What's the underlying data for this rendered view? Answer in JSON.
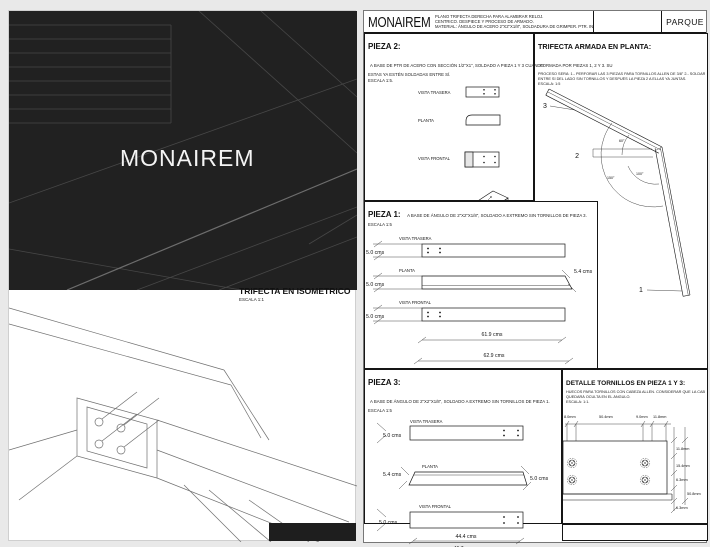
{
  "left_page": {
    "cover_title": "MONAIREM",
    "iso_title": "TRIFECTA EN ISOMETRICO",
    "iso_scale": "ESCALA 1:1"
  },
  "sheet": {
    "title_block": {
      "brand": "MONAIREM",
      "note_line1": "PLANO TRIFECTA DERECHA PARA ALAMBRAR RELOJ.",
      "note_line2": "CENTRICO. DESPIECE Y PROCESO DE ARMADO.",
      "note_line3": "MATERIAL: ÁNGULO DE ACERO 2\"X2\"X1/8\", SOLDADURA DE GRIMPER. PTR. INSTALACIÓN 1 TUBO.",
      "project": "PARQUE"
    },
    "pieza2": {
      "title": "PIEZA 2:",
      "desc_line1": "A BASE DE PTR DE ACERO CON SECCIÓN 1/2\"X1\", SOLDADO A PIEZA 1 Y 3 CUANDO",
      "desc_line2": "ESTAS YA ESTÉN SOLDADAS ENTRE SÍ.",
      "scale": "ESCALA 1:5.",
      "view_trasera": "VISTA TRASERA",
      "view_planta": "PLANTA",
      "view_frontal": "VISTA FRONTAL",
      "view_iso": "ISOMÉTRICO"
    },
    "trifecta": {
      "title": "TRIFECTA ARMADA EN PLANTA:",
      "desc_line1": "FORMADA POR PIEZAS 1, 2 Y 3. SU",
      "desc_line2": "PROCESO SERÁ: 1.- PERFORAR LAS 3 PIEZAS PARA TORNILLOS ALLEN DE 3/8\"  2.- SOLDAR PIEZAS 1 Y 3",
      "desc_line3": "ENTRE SÍ DEL LADO SIN TORNILLOS Y DESPUÉS LA PIEZA 2 A ELLAS YA JUNTAS.",
      "scale": "ESCALA: 1:5",
      "label_1": "1",
      "label_2": "2",
      "label_3": "3",
      "angle_small": "60°",
      "angle_mid": "100°",
      "angle_large": "150°"
    },
    "pieza1": {
      "title": "PIEZA 1:",
      "desc": "A BASE DE ÁNGULO DE 2\"X2\"X1/8\", SOLDADO A EXTREMO SIN TORNILLOS DE PIEZA 3.",
      "scale": "ESCALA 1:5",
      "view_trasera": "VISTA TRASERA",
      "view_planta": "PLANTA",
      "view_frontal": "VISTA FRONTAL",
      "dim_trasera": "5.0 cms",
      "dim_planta": "5.0 cms",
      "dim_frontal": "5.0 cms",
      "dim_end": "5.4 cms",
      "dim_len1": "61.9 cms",
      "dim_len2": "62.9 cms"
    },
    "pieza3": {
      "title": "PIEZA 3:",
      "desc": "A BASE DE ÁNGULO DE 2\"X2\"X1/8\", SOLDADO A EXTREMO SIN TORNILLOS DE PIEZA 1.",
      "scale": "ESCALA 1:5",
      "view_trasera": "VISTA TRASERA",
      "view_planta": "PLANTA",
      "view_frontal": "VISTA FRONTAL",
      "dim_trasera": "5.0 cms",
      "dim_planta_left": "5.4 cms",
      "dim_planta_right": "5.0 cms",
      "dim_frontal": "5.0 cms",
      "dim_len1": "44.4 cms",
      "dim_len2": "46.7 cms"
    },
    "detalle": {
      "title": "DETALLE TORNILLOS EN PIEZA 1 Y 3:",
      "desc_line1": "HUECOS PARA TORNILLOS CON CABEZA ALLEN. CONSIDERAR QUE LA CABEZA",
      "desc_line2": "QUEDARÁ OCULTA EN EL ÁNGULO.",
      "scale": "ESCALA: 1:1.",
      "dim_top_1": "8.0mm",
      "dim_top_2": "50.4mm",
      "dim_top_3": "9.0mm",
      "dim_top_4": "11.8mm",
      "dim_right_1": "11.8mm",
      "dim_right_2": "15.4mm",
      "dim_right_3": "6.3mm",
      "dim_right_4": "50.8mm",
      "dim_right_5": "6.3mm"
    }
  }
}
